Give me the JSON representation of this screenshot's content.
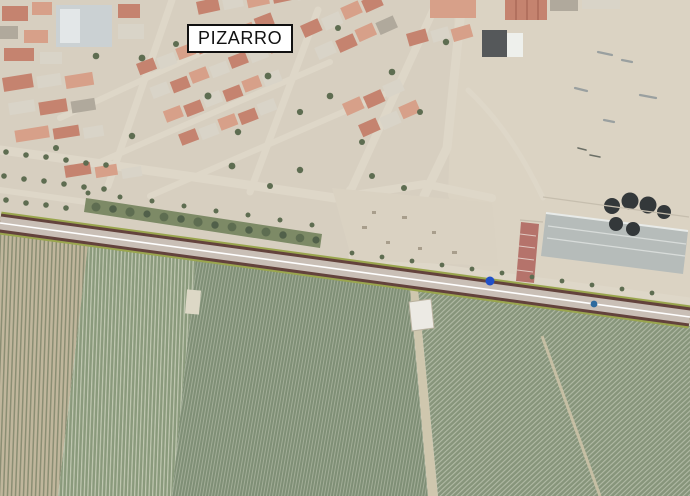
{
  "map": {
    "kind": "aerial-satellite-map",
    "place_label": "PIZARRO",
    "markers": [
      {
        "name": "poi-marker-blue",
        "color": "#2050c8"
      },
      {
        "name": "poi-marker-teal",
        "color": "#2e6a9e"
      }
    ],
    "colors": {
      "urban_ground": "#d7cfc0",
      "dirt_open": "#dbd3c3",
      "vacant_lot": "#dad2c2",
      "park_green": "#7d8a66",
      "tree_green": "#5e6d51",
      "roof_red": "#c5836f",
      "roof_dark": "#55585a",
      "industrial_roof": "#b6bcba",
      "silo_dark": "#33383a",
      "red_building": "#b5736b",
      "field_tan": "#c0b69c",
      "field_green": "#8a9a7c",
      "field_center_green": "#7f8f76",
      "field_right_green": "#87957b",
      "field_track": "#cfc7ae",
      "road_border_green": "#9aa64e",
      "road_edge_dark": "#63423c",
      "road_surface": "#c9bfb6",
      "road_center_line": "#ffffff",
      "shed_white": "#eceae4",
      "label_background": "#ffffff",
      "label_border": "#111111",
      "label_text": "#111111"
    }
  }
}
